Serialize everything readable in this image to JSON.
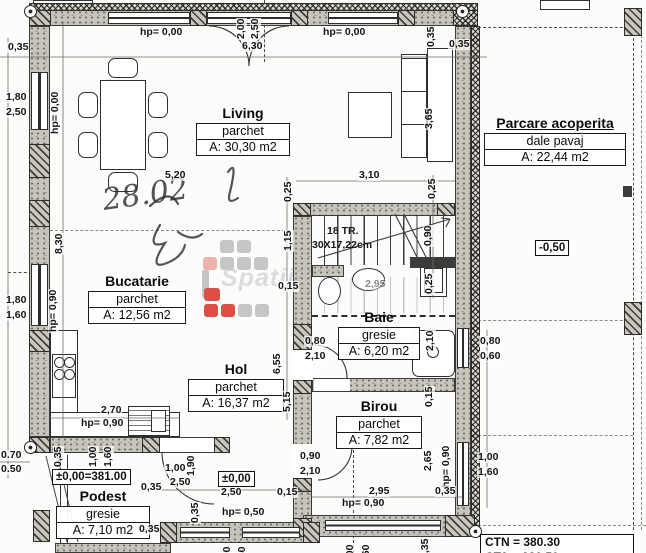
{
  "drawing": {
    "type": "floor-plan",
    "handwriting": {
      "text": "28.02"
    },
    "watermark": {
      "text": "Spatii"
    }
  },
  "colors": {
    "watermark_red": "#dd4f44",
    "watermark_lightred": "#ecb3aa",
    "watermark_gray": "#c6c6c6",
    "watermark_text": "#dcdcdc",
    "wall_fill": "#c7c4bc",
    "line": "#2e2e2e"
  },
  "stairs": {
    "line1": "18 TR.",
    "line2": "30X17,22cm"
  },
  "levels": {
    "entry": "±0,00=381.00",
    "zero": "±0,00",
    "parcare": "-0,50"
  },
  "survey": {
    "line1": "CTN = 380.30",
    "line2": "CTA = 380,50"
  },
  "rooms": [
    {
      "name": "Living",
      "finish": "parchet",
      "area": "A: 30,30 m2",
      "x": 196,
      "y": 106,
      "w": 94
    },
    {
      "name": "Bucatarie",
      "finish": "parchet",
      "area": "A: 12,56 m2",
      "x": 88,
      "y": 274,
      "w": 98
    },
    {
      "name": "Hol",
      "finish": "parchet",
      "area": "A: 16,37 m2",
      "x": 188,
      "y": 362,
      "w": 96
    },
    {
      "name": "Baie",
      "finish": "gresie",
      "area": "A: 6,20 m2",
      "x": 338,
      "y": 310,
      "w": 82
    },
    {
      "name": "Birou",
      "finish": "parchet",
      "area": "A: 7,82 m2",
      "x": 336,
      "y": 399,
      "w": 86
    },
    {
      "name": "Podest",
      "finish": "gresie",
      "area": "A: 7,10 m2",
      "x": 56,
      "y": 489,
      "w": 94
    },
    {
      "name": "Parcare acoperita",
      "finish": "dale pavaj",
      "area": "A: 22,44 m2",
      "x": 484,
      "y": 116,
      "w": 142,
      "u": 1
    }
  ],
  "dims": [
    {
      "t": "0,35",
      "x": 7,
      "y": 42
    },
    {
      "t": "hp= 0,00",
      "x": 139,
      "y": 27
    },
    {
      "t": "2,00",
      "x": 236,
      "y": 40,
      "r": 1
    },
    {
      "t": "2,50",
      "x": 250,
      "y": 40,
      "r": 1
    },
    {
      "t": "6,30",
      "x": 241,
      "y": 41
    },
    {
      "t": "hp= 0,00",
      "x": 322,
      "y": 27
    },
    {
      "t": "0,35",
      "x": 426,
      "y": 48,
      "r": 1
    },
    {
      "t": "0,35",
      "x": 448,
      "y": 39
    },
    {
      "t": "1,80",
      "x": 5,
      "y": 92
    },
    {
      "t": "2,50",
      "x": 5,
      "y": 107
    },
    {
      "t": "hp= 0,00",
      "x": 50,
      "y": 135,
      "r": 1
    },
    {
      "t": "3,65",
      "x": 424,
      "y": 130,
      "r": 1
    },
    {
      "t": "5,20",
      "x": 164,
      "y": 170
    },
    {
      "t": "3,10",
      "x": 358,
      "y": 170
    },
    {
      "t": "0,25",
      "x": 283,
      "y": 203,
      "r": 1
    },
    {
      "t": "0,25",
      "x": 427,
      "y": 200,
      "r": 1
    },
    {
      "t": "8,30",
      "x": 54,
      "y": 255,
      "r": 1
    },
    {
      "t": "1,15",
      "x": 283,
      "y": 252,
      "r": 1
    },
    {
      "t": "0,90",
      "x": 423,
      "y": 247,
      "r": 1
    },
    {
      "t": "0,25",
      "x": 424,
      "y": 295,
      "r": 1
    },
    {
      "t": "2,95",
      "x": 364,
      "y": 279,
      "f": 1
    },
    {
      "t": "0,15",
      "x": 277,
      "y": 281
    },
    {
      "t": "1,80",
      "x": 5,
      "y": 295
    },
    {
      "t": "1,60",
      "x": 5,
      "y": 310
    },
    {
      "t": "hp= 0,90",
      "x": 48,
      "y": 333,
      "r": 1
    },
    {
      "t": "0,80",
      "x": 304,
      "y": 336
    },
    {
      "t": "2,10",
      "x": 304,
      "y": 351
    },
    {
      "t": "2,10",
      "x": 425,
      "y": 352,
      "r": 1
    },
    {
      "t": "0,80",
      "x": 479,
      "y": 336
    },
    {
      "t": "0,60",
      "x": 479,
      "y": 351
    },
    {
      "t": "6,55",
      "x": 272,
      "y": 375,
      "r": 1
    },
    {
      "t": "5,15",
      "x": 282,
      "y": 413,
      "r": 1
    },
    {
      "t": "0,15",
      "x": 424,
      "y": 408,
      "r": 1
    },
    {
      "t": "2,70",
      "x": 100,
      "y": 405
    },
    {
      "t": "hp= 0,90",
      "x": 80,
      "y": 418
    },
    {
      "t": "0,35",
      "x": 53,
      "y": 468,
      "r": 1
    },
    {
      "t": "1,00",
      "x": 88,
      "y": 468,
      "r": 1
    },
    {
      "t": "1,60",
      "x": 103,
      "y": 468,
      "r": 1
    },
    {
      "t": "0.70",
      "x": 0,
      "y": 450
    },
    {
      "t": "0.50",
      "x": 0,
      "y": 464
    },
    {
      "t": "1,00",
      "x": 164,
      "y": 463
    },
    {
      "t": "2,50",
      "x": 169,
      "y": 477
    },
    {
      "t": "1,90",
      "x": 186,
      "y": 477,
      "r": 1
    },
    {
      "t": "2,50",
      "x": 220,
      "y": 487
    },
    {
      "t": "0,15",
      "x": 276,
      "y": 487
    },
    {
      "t": "0,90",
      "x": 299,
      "y": 451
    },
    {
      "t": "2,10",
      "x": 299,
      "y": 466
    },
    {
      "t": "2,65",
      "x": 423,
      "y": 472,
      "r": 1
    },
    {
      "t": "hp= 0,90",
      "x": 441,
      "y": 489,
      "r": 1
    },
    {
      "t": "1,00",
      "x": 477,
      "y": 452
    },
    {
      "t": "1,60",
      "x": 477,
      "y": 467
    },
    {
      "t": "0,35",
      "x": 140,
      "y": 482
    },
    {
      "t": "0,35",
      "x": 138,
      "y": 524
    },
    {
      "t": "0,35",
      "x": 190,
      "y": 524,
      "r": 1
    },
    {
      "t": "hp= 0,50",
      "x": 221,
      "y": 507
    },
    {
      "t": "2,95",
      "x": 368,
      "y": 486
    },
    {
      "t": "0,35",
      "x": 434,
      "y": 486
    },
    {
      "t": "hp= 0,90",
      "x": 341,
      "y": 498
    },
    {
      "t": "1,00",
      "x": 345,
      "y": 566,
      "r": 1
    },
    {
      "t": "1,60",
      "x": 361,
      "y": 566,
      "r": 1
    },
    {
      "t": "0,35",
      "x": 420,
      "y": 560,
      "r": 1
    },
    {
      "t": "1,00",
      "x": 222,
      "y": 568,
      "r": 1
    },
    {
      "t": "2,50",
      "x": 237,
      "y": 568,
      "r": 1
    }
  ]
}
